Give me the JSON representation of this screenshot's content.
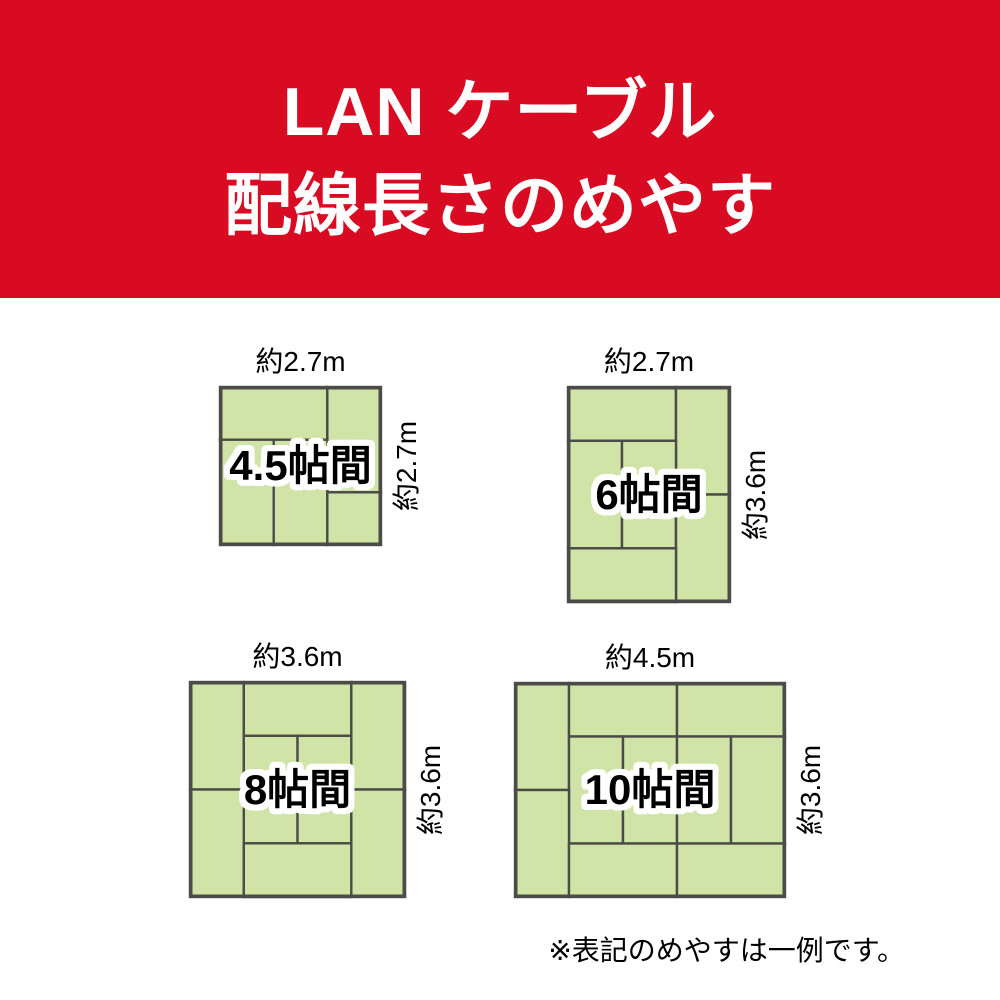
{
  "header": {
    "title_line1": "LAN ケーブル",
    "title_line2": "配線長さのめやす",
    "bg_color": "#d90b23",
    "text_color": "#ffffff"
  },
  "colors": {
    "tatami_fill": "#cfe4a6",
    "tatami_border": "#4b4b47",
    "room_label_text": "#000000",
    "room_label_outline": "#ffffff",
    "dimension_text": "#000000"
  },
  "rooms": [
    {
      "id": "room-4.5-jo",
      "size_label": "4.5帖間",
      "width_label": "約2.7m",
      "height_label": "約2.7m",
      "grid": {
        "cols": 3,
        "rows": 3
      },
      "mats": [
        [
          0,
          0,
          2,
          1
        ],
        [
          2,
          0,
          1,
          2
        ],
        [
          0,
          1,
          1,
          2
        ],
        [
          1,
          1,
          1,
          2
        ],
        [
          2,
          2,
          1,
          1
        ]
      ]
    },
    {
      "id": "room-6-jo",
      "size_label": "6帖間",
      "width_label": "約2.7m",
      "height_label": "約3.6m",
      "grid": {
        "cols": 3,
        "rows": 4
      },
      "mats": [
        [
          0,
          0,
          2,
          1
        ],
        [
          2,
          0,
          1,
          2
        ],
        [
          0,
          1,
          1,
          2
        ],
        [
          1,
          1,
          1,
          2
        ],
        [
          2,
          2,
          1,
          2
        ],
        [
          0,
          3,
          2,
          1
        ]
      ]
    },
    {
      "id": "room-8-jo",
      "size_label": "8帖間",
      "width_label": "約3.6m",
      "height_label": "約3.6m",
      "grid": {
        "cols": 4,
        "rows": 4
      },
      "mats": [
        [
          0,
          0,
          1,
          2
        ],
        [
          1,
          0,
          2,
          1
        ],
        [
          3,
          0,
          1,
          2
        ],
        [
          1,
          1,
          1,
          2
        ],
        [
          2,
          1,
          1,
          2
        ],
        [
          0,
          2,
          1,
          2
        ],
        [
          3,
          2,
          1,
          2
        ],
        [
          1,
          3,
          2,
          1
        ]
      ]
    },
    {
      "id": "room-10-jo",
      "size_label": "10帖間",
      "width_label": "約4.5m",
      "height_label": "約3.6m",
      "grid": {
        "cols": 5,
        "rows": 4
      },
      "mats": [
        [
          0,
          0,
          1,
          2
        ],
        [
          1,
          0,
          2,
          1
        ],
        [
          3,
          0,
          2,
          1
        ],
        [
          1,
          1,
          1,
          2
        ],
        [
          2,
          1,
          1,
          2
        ],
        [
          3,
          1,
          1,
          2
        ],
        [
          4,
          1,
          1,
          2
        ],
        [
          0,
          2,
          1,
          2
        ],
        [
          1,
          3,
          2,
          1
        ],
        [
          3,
          3,
          2,
          1
        ]
      ]
    }
  ],
  "footer": {
    "note": "※表記のめやすは一例です。"
  }
}
